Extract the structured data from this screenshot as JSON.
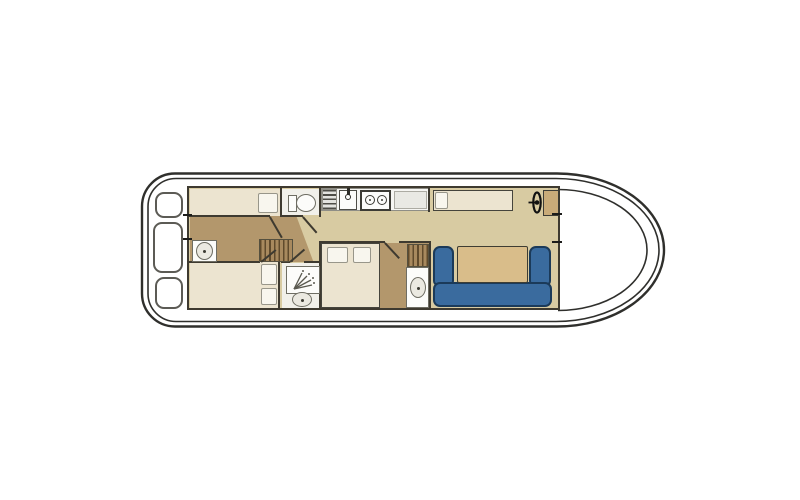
{
  "diagram": {
    "type": "floorplan",
    "subject": "houseboat-deck-plan",
    "orientation": "bow-right-stern-left",
    "areas": [
      {
        "name": "aft-deck",
        "features": [
          "stern-locker-top",
          "stern-locker-middle",
          "stern-locker-bottom"
        ]
      },
      {
        "name": "aft-cabin-port",
        "features": [
          "single-berth",
          "pillow"
        ]
      },
      {
        "name": "aft-cabin-starboard",
        "features": [
          "double-berth",
          "pillow",
          "pillow"
        ]
      },
      {
        "name": "aft-corridor",
        "features": [
          "washbasin",
          "companionway-steps"
        ]
      },
      {
        "name": "wc-room",
        "features": [
          "toilet"
        ]
      },
      {
        "name": "shower-room",
        "features": [
          "shower-tray",
          "washbasin"
        ]
      },
      {
        "name": "galley",
        "features": [
          "draining-board",
          "sink",
          "two-burner-stove",
          "counter"
        ]
      },
      {
        "name": "midship-cabin",
        "features": [
          "double-bed",
          "two-pillows",
          "wardrobe",
          "washbasin"
        ]
      },
      {
        "name": "saloon",
        "features": [
          "bench-seat",
          "u-shaped-sofa",
          "table"
        ]
      },
      {
        "name": "helm-station",
        "features": [
          "steering-wheel",
          "helm-console"
        ]
      },
      {
        "name": "bow-deck",
        "features": []
      }
    ],
    "door_count": 5,
    "washbasin_count": 3
  },
  "palette": {
    "hull_line": "#2f2f2c",
    "wall": "#3e3a30",
    "floor_tan": "#d8cba2",
    "room_cream": "#ece4d0",
    "corridor_brown": "#b3976c",
    "hatch_base": "#a8895e",
    "hatch_line": "#604a2c",
    "wetroom": "#f1f0ea",
    "counter": "#f6f6f3",
    "counter_border": "#8f8e86",
    "fixture": "#fcfcfa",
    "fixture_border": "#6e6d63",
    "basin": "#ebe9e1",
    "pillow": "#f8f6ee",
    "pillow_border": "#98968a",
    "sofa_blue": "#3a6b9e",
    "sofa_border": "#1b3a59",
    "table_tan": "#d9bd8a",
    "table_border": "#3e3d33",
    "console_tan": "#c9ab79",
    "bed_border": "#45443c",
    "locker_border": "#5c5b55",
    "tick": "#1c1c1a",
    "wheel_black": "#111111"
  }
}
